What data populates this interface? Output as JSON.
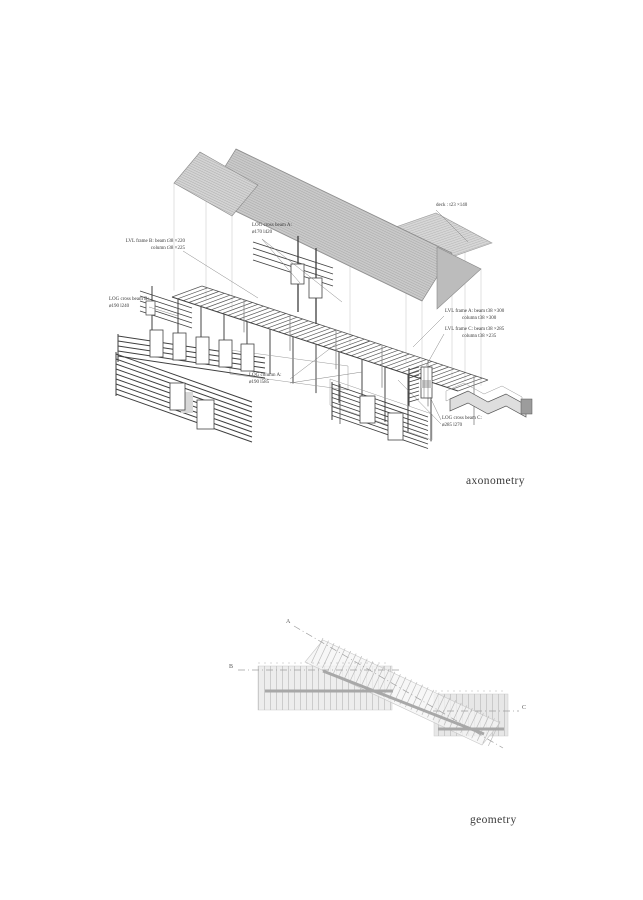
{
  "captions": {
    "axonometry": "axonometry",
    "geometry": "geometry"
  },
  "annotations": {
    "deck": "deck : t23 ×140",
    "log_cross_beam_a": {
      "line1": "LOG cross beam A:",
      "line2": "ø170 l420"
    },
    "lvl_frame_b": {
      "line1": "LVL frame B: beam t38 ×220",
      "line2": "column t38 ×225"
    },
    "log_cross_beam_b": {
      "line1": "LOG cross beam B:",
      "line2": "ø190 l240"
    },
    "log_column_a": {
      "line1": "LOG column A:",
      "line2": "ø190 l585"
    },
    "lvl_frame_a": {
      "line1": "LVL frame A: beam t38 ×300",
      "line2": "column t38 ×300"
    },
    "lvl_frame_c": {
      "line1": "LVL frame C: beam t38 ×285",
      "line2": "column t38 ×235"
    },
    "log_cross_beam_c": {
      "line1": "LOG cross beam C:",
      "line2": "ø285 l270"
    }
  },
  "geometry_axes": {
    "a": "A",
    "b": "B",
    "c": "C"
  },
  "colors": {
    "background": "#ffffff",
    "roof_fill": "#c9c9c9",
    "roof_fill_light": "#d6d6d6",
    "gable_fill": "#bcbcbc",
    "linework": "#4a4a4a",
    "hatch": "#7d7d7d",
    "band_fill": "#ededed",
    "band_hatch": "#bdbdbd",
    "beam_gray": "#a8a8a8",
    "text": "#3a3a3a"
  }
}
